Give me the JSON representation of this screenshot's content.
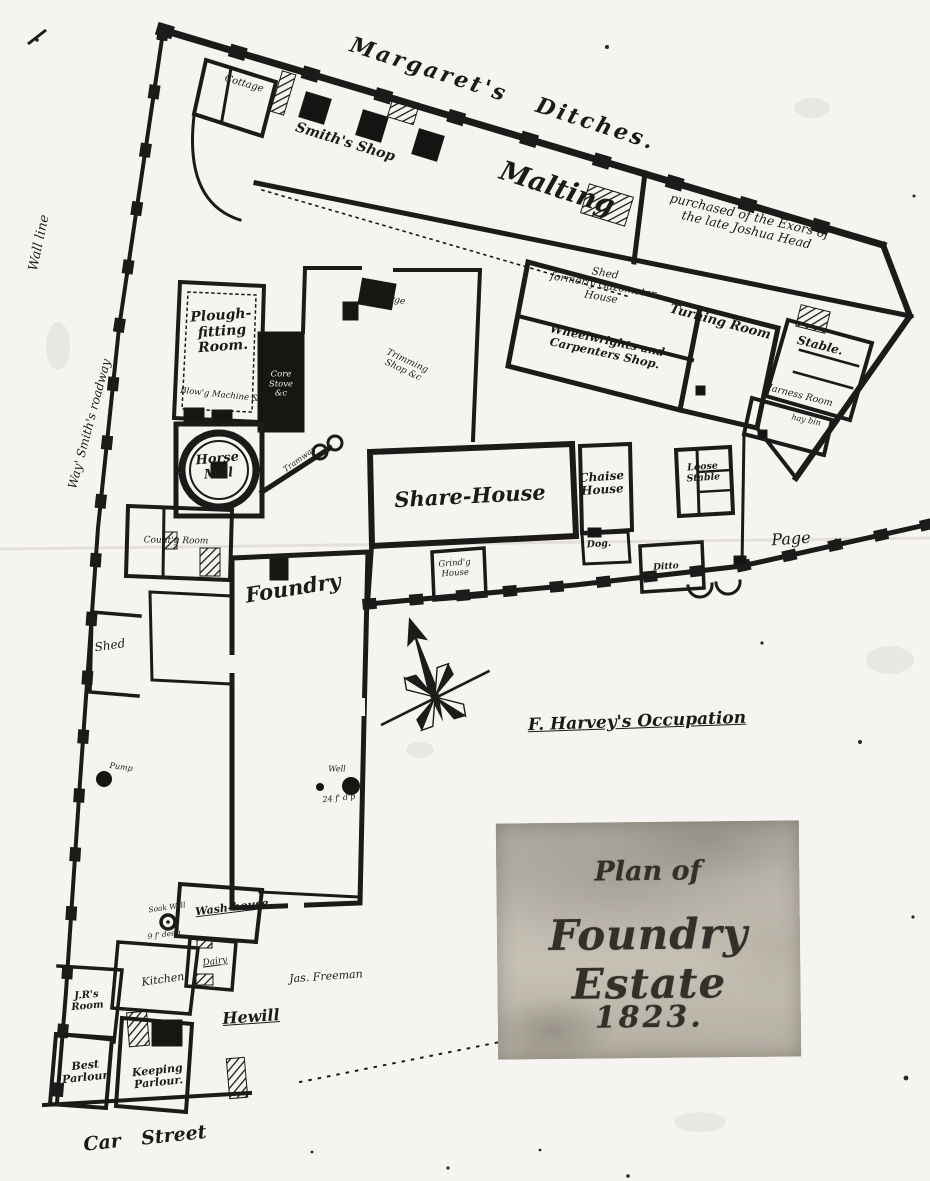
{
  "title": {
    "line1": "Plan of",
    "line2": "Foundry Estate",
    "line3": "1823."
  },
  "colors": {
    "ink": "#1c1b19",
    "paper": "#f5f4f0",
    "cartouche": "#bcb7ac"
  },
  "compass": {
    "name": "compass-rose",
    "direction": "north-up-left"
  },
  "labels": [
    {
      "id": "margarets-ditches",
      "text": "Margaret's  Ditches.",
      "x": 503,
      "y": 94,
      "rot": 18,
      "size": 22,
      "bold": true,
      "spacing": 3,
      "wordSpacing": 20
    },
    {
      "id": "cottage",
      "text": "Cottage",
      "x": 244,
      "y": 84,
      "rot": 16,
      "size": 10
    },
    {
      "id": "smiths-shop",
      "text": "Smith's Shop",
      "x": 345,
      "y": 143,
      "rot": 17,
      "size": 14,
      "bold": true
    },
    {
      "id": "malting",
      "text": "Malting",
      "x": 557,
      "y": 189,
      "rot": 18,
      "size": 27,
      "bold": true
    },
    {
      "id": "purchased-note",
      "text": "purchased of the Exors of\nthe late Joshua Head",
      "x": 748,
      "y": 223,
      "rot": 13,
      "size": 12.5
    },
    {
      "id": "shed-gazometer",
      "text": "Shed\nformerly Gazometer\nHouse",
      "x": 603,
      "y": 286,
      "rot": 10,
      "size": 10.5
    },
    {
      "id": "wheelwrights-shop",
      "text": "Wheelwrights and\nCarpenters Shop.",
      "x": 606,
      "y": 347,
      "rot": 12,
      "size": 11.5,
      "bold": true
    },
    {
      "id": "turning-room",
      "text": "Turning Room",
      "x": 720,
      "y": 323,
      "rot": 15,
      "size": 13,
      "bold": true
    },
    {
      "id": "stable",
      "text": "Stable.",
      "x": 820,
      "y": 346,
      "rot": 14,
      "size": 12,
      "bold": true
    },
    {
      "id": "harness-room",
      "text": "Harness Room",
      "x": 798,
      "y": 396,
      "rot": 14,
      "size": 9.5
    },
    {
      "id": "hay-bin",
      "text": "hay bin",
      "x": 806,
      "y": 421,
      "rot": 12,
      "size": 8
    },
    {
      "id": "plough-fitting-room",
      "text": "Plough-\nfitting\nRoom.",
      "x": 222,
      "y": 332,
      "rot": -4,
      "size": 14,
      "bold": true
    },
    {
      "id": "forge",
      "text": "Forge",
      "x": 392,
      "y": 300,
      "rot": 10,
      "size": 9
    },
    {
      "id": "trimming-shop",
      "text": "Trimming\nShop &c",
      "x": 405,
      "y": 366,
      "rot": 25,
      "size": 9
    },
    {
      "id": "blowg-machine",
      "text": "Blow'g Machine &c",
      "x": 222,
      "y": 396,
      "rot": 6,
      "size": 8.5
    },
    {
      "id": "core-stove",
      "text": "Core\nStove\n&c",
      "x": 281,
      "y": 385,
      "rot": 0,
      "size": 8.5,
      "color": "#eeece6"
    },
    {
      "id": "horse-mill",
      "text": "Horse\nMill",
      "x": 218,
      "y": 467,
      "rot": -5,
      "size": 13,
      "bold": true
    },
    {
      "id": "tramway",
      "text": "Tramway",
      "x": 300,
      "y": 460,
      "rot": -36,
      "size": 8
    },
    {
      "id": "share-house",
      "text": "Share-House",
      "x": 470,
      "y": 496,
      "rot": -3,
      "size": 21,
      "bold": true
    },
    {
      "id": "chaise-house",
      "text": "Chaise\nHouse",
      "x": 602,
      "y": 484,
      "rot": -4,
      "size": 12,
      "bold": true
    },
    {
      "id": "loose-stable",
      "text": "Loose\nStable",
      "x": 703,
      "y": 473,
      "rot": -4,
      "size": 9.5,
      "bold": true
    },
    {
      "id": "page",
      "text": "Page",
      "x": 791,
      "y": 539,
      "rot": -4,
      "size": 16
    },
    {
      "id": "dog",
      "text": "Dog.",
      "x": 599,
      "y": 545,
      "rot": -4,
      "size": 9.5,
      "bold": true
    },
    {
      "id": "ditto",
      "text": "Ditto",
      "x": 666,
      "y": 567,
      "rot": -4,
      "size": 9,
      "bold": true
    },
    {
      "id": "grindg-house",
      "text": "Grind'g\nHouse",
      "x": 455,
      "y": 569,
      "rot": -4,
      "size": 8.5
    },
    {
      "id": "countg-room",
      "text": "Count'g  Room",
      "x": 176,
      "y": 541,
      "rot": 1,
      "size": 9
    },
    {
      "id": "foundry",
      "text": "Foundry",
      "x": 293,
      "y": 588,
      "rot": -9,
      "size": 21,
      "bold": true
    },
    {
      "id": "shed-left",
      "text": "Shed",
      "x": 110,
      "y": 646,
      "rot": -8,
      "size": 12
    },
    {
      "id": "wall-line",
      "text": "Wall line",
      "x": 40,
      "y": 243,
      "rot": -78,
      "size": 13
    },
    {
      "id": "roadway-note",
      "text": "Way' Smith's roadway",
      "x": 90,
      "y": 424,
      "rot": -75,
      "size": 12
    },
    {
      "id": "harveys-occupation",
      "text": "F. Harvey's Occupation",
      "x": 637,
      "y": 722,
      "rot": -2,
      "size": 17,
      "bold": true,
      "underline": true
    },
    {
      "id": "well",
      "text": "Well",
      "x": 337,
      "y": 770,
      "rot": 0,
      "size": 8
    },
    {
      "id": "well-depth",
      "text": "24 f' d'p",
      "x": 339,
      "y": 799,
      "rot": -6,
      "size": 8
    },
    {
      "id": "pump",
      "text": "Pump",
      "x": 121,
      "y": 768,
      "rot": 8,
      "size": 8
    },
    {
      "id": "soak-well",
      "text": "Soak Well",
      "x": 167,
      "y": 908,
      "rot": -8,
      "size": 7.5
    },
    {
      "id": "soak-well-depth",
      "text": "9 f' deep",
      "x": 164,
      "y": 935,
      "rot": -8,
      "size": 7.5
    },
    {
      "id": "wash-house",
      "text": "Wash-house",
      "x": 232,
      "y": 908,
      "rot": -7,
      "size": 11,
      "bold": true,
      "underline": true
    },
    {
      "id": "dairy",
      "text": "Dairy",
      "x": 215,
      "y": 962,
      "rot": -8,
      "size": 9,
      "underline": true
    },
    {
      "id": "kitchen",
      "text": "Kitchen",
      "x": 163,
      "y": 980,
      "rot": -8,
      "size": 11
    },
    {
      "id": "jrs-room",
      "text": "J.R's\nRoom",
      "x": 87,
      "y": 1001,
      "rot": -5,
      "size": 10,
      "bold": true
    },
    {
      "id": "jas-freeman",
      "text": "Jas. Freeman",
      "x": 326,
      "y": 977,
      "rot": -4,
      "size": 11
    },
    {
      "id": "hewill",
      "text": "Hewill",
      "x": 251,
      "y": 1017,
      "rot": -4,
      "size": 16,
      "bold": true,
      "underline": true
    },
    {
      "id": "best-parlour",
      "text": "Best\nParlour.",
      "x": 86,
      "y": 1072,
      "rot": -6,
      "size": 11,
      "bold": true
    },
    {
      "id": "keeping-parlour",
      "text": "Keeping\nParlour.",
      "x": 158,
      "y": 1077,
      "rot": -6,
      "size": 11,
      "bold": true
    },
    {
      "id": "car-street",
      "text": "Car  Street",
      "x": 145,
      "y": 1139,
      "rot": -6,
      "size": 19,
      "bold": true,
      "wordSpacing": 14
    }
  ]
}
